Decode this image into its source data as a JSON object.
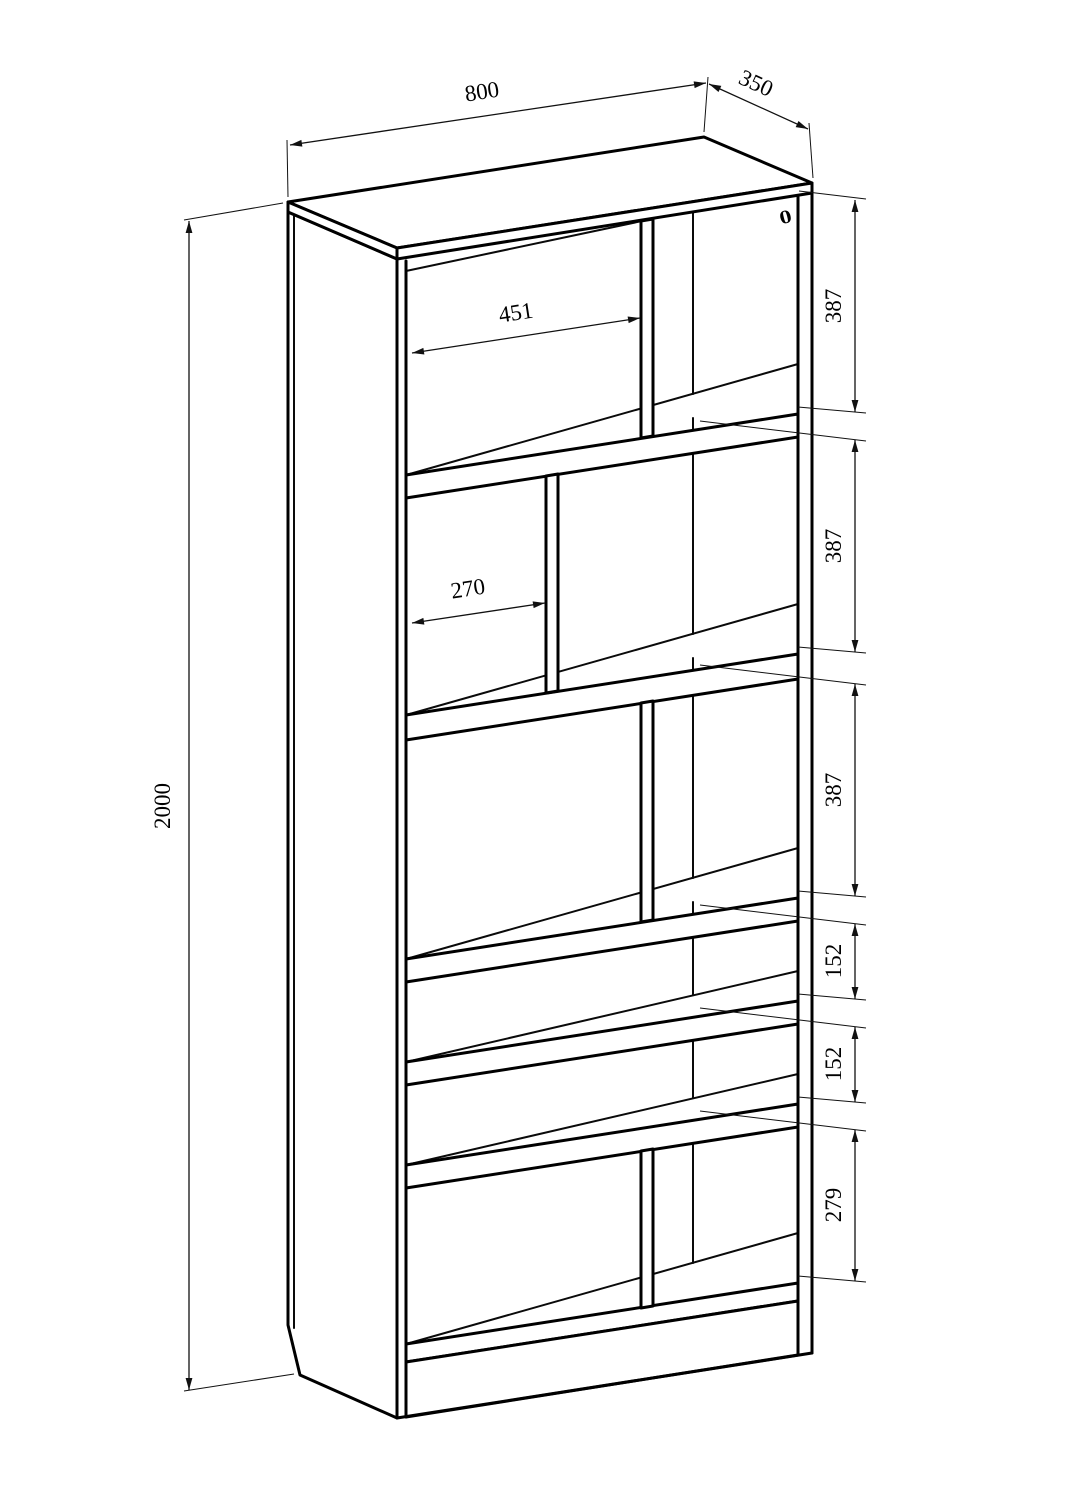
{
  "drawing": {
    "kind": "bookshelf dimension drawing"
  },
  "annotations": {
    "hole_marker": "0"
  },
  "dimensions": {
    "width": "800",
    "depth": "350",
    "height": "2000",
    "section1_inner_width": "451",
    "section2_inner_width": "270",
    "right_sections": [
      "387",
      "387",
      "387",
      "152",
      "152",
      "279"
    ]
  }
}
